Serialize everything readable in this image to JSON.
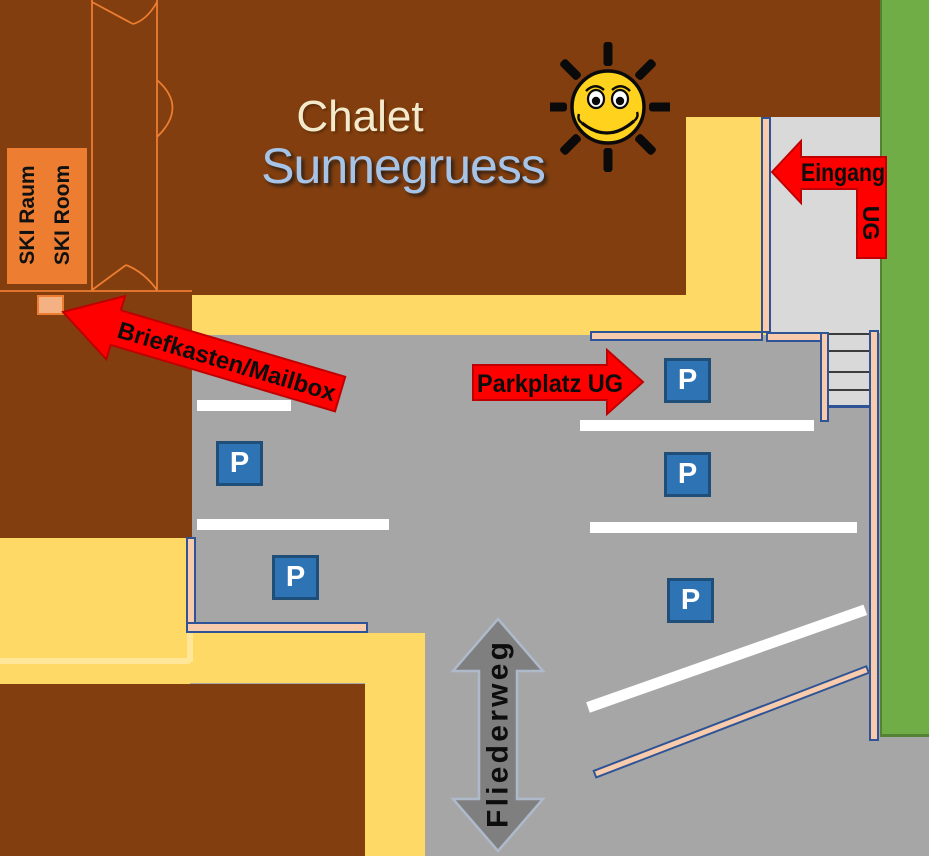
{
  "title": {
    "line1": "Chalet",
    "line2": "Sunnegruess"
  },
  "ski_room": {
    "label_de": "SKI Raum",
    "label_en": "SKI Room"
  },
  "arrows": {
    "entrance": {
      "label": "Eingang",
      "sublabel": "UG"
    },
    "mailbox": {
      "label": "Briefkasten/Mailbox"
    },
    "parking": {
      "label": "Parkplatz UG"
    }
  },
  "street": {
    "name": "Fliederweg"
  },
  "parking_sign": {
    "symbol": "P",
    "count": 5
  },
  "icons": {
    "sun": "smiley-sun",
    "parking": "parking-p-sign"
  },
  "colors": {
    "building_brown": "#823E0E",
    "path_yellow": "#FFD966",
    "path_yellow_light": "#FFE699",
    "asphalt_gray": "#A6A6A6",
    "walkway_gray": "#D9D9D9",
    "lawn_green": "#70AD47",
    "lawn_green_dark": "#548235",
    "wall_tan": "#F8CBAD",
    "wall_outline_blue": "#2E5496",
    "sign_blue": "#2E74B5",
    "sign_blue_dark": "#1F4E79",
    "arrow_red": "#FF0000",
    "arrow_red_dark": "#C00000",
    "street_arrow_gray": "#7F7F7F",
    "sun_yellow": "#FFD21E",
    "title_cream": "#F3EACB",
    "title_blue": "#A6C4E8",
    "outline_orange": "#ED7D31",
    "mailbox_tan": "#F4B183"
  }
}
